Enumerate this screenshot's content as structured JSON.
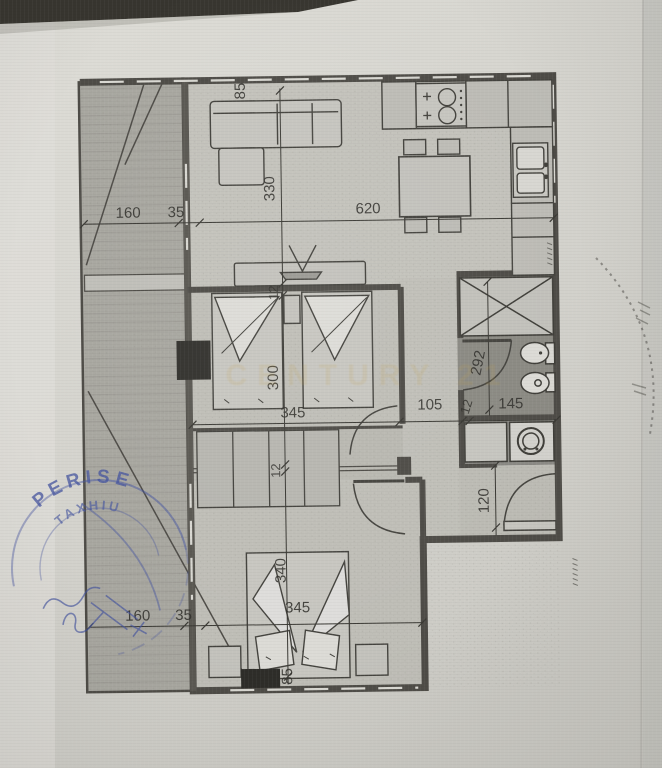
{
  "plan": {
    "dims": {
      "top_85": "85",
      "living_330": "330",
      "living_620": "620",
      "balc_160_t": "160",
      "balc_35_t": "35",
      "w12_a": "12",
      "bed1_300": "300",
      "bed1_345": "345",
      "corr_105": "105",
      "w12_b": "12",
      "bath_145": "145",
      "bath_292": "292",
      "hall_120": "120",
      "w12_c": "12",
      "bed2_340": "340",
      "bed2_345": "345",
      "balc_160_b": "160",
      "balc_35_b": "35",
      "bottom_85": "85"
    }
  },
  "watermark": {
    "text": "CENTURY 21",
    "color": "#c5a24a"
  },
  "stamp_left": {
    "arc_text": "PERISE",
    "name_text": "TAXHIU",
    "ink_color": "#44549f"
  },
  "colors": {
    "paper": "#d8d7d1",
    "wall": "#4e4c47",
    "room_floor": "#c3c2bb",
    "balcony_floor": "#a8a7a0",
    "bathroom_floor": "#8b8a83"
  }
}
